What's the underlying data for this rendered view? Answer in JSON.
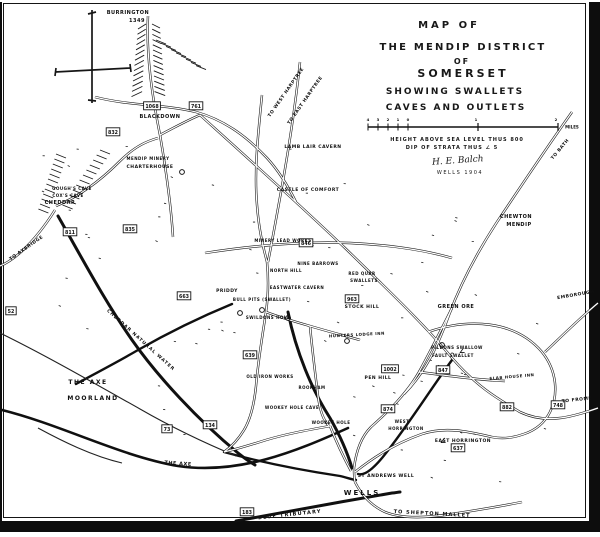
{
  "title": {
    "line1": "MAP OF",
    "line2": "THE MENDIP DISTRICT",
    "line3": "OF",
    "line4": "SOMERSET",
    "line5": "SHOWING SWALLETS",
    "line6": "CAVES AND OUTLETS"
  },
  "notes": {
    "height_note": "HEIGHT ABOVE SEA LEVEL THUS 800",
    "dip_note": "DIP OF STRATA THUS ∠ 5",
    "signature": "H. E. Balch",
    "place_date": "WELLS 1904"
  },
  "scale": {
    "furlong_labels": [
      "4",
      "3",
      "2",
      "1",
      "0"
    ],
    "mile_labels": [
      "1",
      "2"
    ],
    "unit": "MILES"
  },
  "colors": {
    "ink": "#161616",
    "paper": "#ffffff"
  },
  "compass": {
    "name": "north-cross"
  },
  "labels": [
    {
      "text": "BURRINGTON",
      "x": 128,
      "y": 14,
      "fs": 5
    },
    {
      "text": "1349",
      "x": 137,
      "y": 22,
      "fs": 5
    },
    {
      "text": "BLACKDOWN",
      "x": 160,
      "y": 118,
      "fs": 5
    },
    {
      "text": "MENDIP MINERY",
      "x": 148,
      "y": 160,
      "fs": 4
    },
    {
      "text": "CHARTERHOUSE",
      "x": 150,
      "y": 168,
      "fs": 4.5
    },
    {
      "text": "GOUGH'S CAVE",
      "x": 72,
      "y": 190,
      "fs": 4
    },
    {
      "text": "COX'S CAVE",
      "x": 68,
      "y": 197,
      "fs": 4
    },
    {
      "text": "CHEDDAR",
      "x": 60,
      "y": 204,
      "fs": 5
    },
    {
      "text": "TO AXBRIDGE",
      "x": 27,
      "y": 249,
      "fs": 4.5,
      "rot": -35
    },
    {
      "text": "LAMB LAIR CAVERN",
      "x": 313,
      "y": 148,
      "fs": 4.5
    },
    {
      "text": "CASTLE OF COMFORT",
      "x": 308,
      "y": 191,
      "fs": 4.5
    },
    {
      "text": "TO WEST HARPTREE",
      "x": 287,
      "y": 93,
      "fs": 4.5,
      "rot": -55
    },
    {
      "text": "TO EAST HARPTREE",
      "x": 306,
      "y": 101,
      "fs": 4.5,
      "rot": -55
    },
    {
      "text": "TO BATH",
      "x": 561,
      "y": 150,
      "fs": 4.5,
      "rot": -50
    },
    {
      "text": "CHEWTON",
      "x": 516,
      "y": 218,
      "fs": 5
    },
    {
      "text": "MENDIP",
      "x": 519,
      "y": 226,
      "fs": 5
    },
    {
      "text": "GREEN ORE",
      "x": 456,
      "y": 308,
      "fs": 5
    },
    {
      "text": "EMBOROUGH",
      "x": 576,
      "y": 296,
      "fs": 4.5,
      "rot": -10
    },
    {
      "text": "MINERY LEAD WORKS",
      "x": 283,
      "y": 242,
      "fs": 4
    },
    {
      "text": "NORTH HILL",
      "x": 286,
      "y": 272,
      "fs": 4
    },
    {
      "text": "PRIDDY",
      "x": 227,
      "y": 292,
      "fs": 4.5
    },
    {
      "text": "BULL PITS (SWALLET)",
      "x": 262,
      "y": 301,
      "fs": 4
    },
    {
      "text": "EASTWATER CAVERN",
      "x": 297,
      "y": 289,
      "fs": 4
    },
    {
      "text": "SWILDONS HOLE",
      "x": 268,
      "y": 319,
      "fs": 4
    },
    {
      "text": "NINE BARROWS",
      "x": 318,
      "y": 265,
      "fs": 4
    },
    {
      "text": "STOCK HILL",
      "x": 362,
      "y": 308,
      "fs": 4.5
    },
    {
      "text": "RED QUAR",
      "x": 362,
      "y": 275,
      "fs": 4
    },
    {
      "text": "SWALLETS",
      "x": 364,
      "y": 282,
      "fs": 4
    },
    {
      "text": "HUNTERS LODGE INN",
      "x": 357,
      "y": 336,
      "fs": 4,
      "rot": -3
    },
    {
      "text": "PEN HILL",
      "x": 378,
      "y": 379,
      "fs": 4.5
    },
    {
      "text": "OLD IRON WORKS",
      "x": 270,
      "y": 378,
      "fs": 4
    },
    {
      "text": "ROOKHAM",
      "x": 312,
      "y": 389,
      "fs": 4
    },
    {
      "text": "WOOKEY HOLE CAVE",
      "x": 292,
      "y": 409,
      "fs": 4
    },
    {
      "text": "WOOKEY HOLE",
      "x": 331,
      "y": 424,
      "fs": 4
    },
    {
      "text": "WEST",
      "x": 402,
      "y": 423,
      "fs": 4
    },
    {
      "text": "HORRINGTON",
      "x": 406,
      "y": 430,
      "fs": 4
    },
    {
      "text": "EAST HORRINGTON",
      "x": 463,
      "y": 442,
      "fs": 4.5
    },
    {
      "text": "SLAB HOUSE INN",
      "x": 512,
      "y": 378,
      "fs": 4,
      "rot": -5
    },
    {
      "text": "PILDONS SWALLOW",
      "x": 457,
      "y": 349,
      "fs": 4
    },
    {
      "text": "FAULT SWALLET",
      "x": 453,
      "y": 357,
      "fs": 4
    },
    {
      "text": "ST ANDREWS WELL",
      "x": 386,
      "y": 477,
      "fs": 4.5
    },
    {
      "text": "WELLS",
      "x": 362,
      "y": 495,
      "fs": 7,
      "ls": 2
    },
    {
      "text": "THE AXE",
      "x": 88,
      "y": 384,
      "fs": 6,
      "ls": 1.5
    },
    {
      "text": "MOORLAND",
      "x": 93,
      "y": 400,
      "fs": 6,
      "ls": 1.5
    },
    {
      "text": "THE AXE",
      "x": 178,
      "y": 465,
      "fs": 5,
      "rot": 4
    },
    {
      "text": "BLUE TRIBUTARY",
      "x": 290,
      "y": 516,
      "fs": 5,
      "rot": -6,
      "ls": 1.2
    },
    {
      "text": "TO SHEPTON MALLET",
      "x": 432,
      "y": 515,
      "fs": 5,
      "rot": 3,
      "ls": 1
    },
    {
      "text": "TO FROME",
      "x": 577,
      "y": 401,
      "fs": 4.5,
      "rot": -6
    },
    {
      "text": "CHEDDAR NATURAL WATER",
      "x": 140,
      "y": 341,
      "fs": 4.5,
      "rot": 42,
      "ls": 1
    }
  ],
  "elevation_boxes": [
    {
      "value": "1068",
      "x": 152,
      "y": 106
    },
    {
      "value": "832",
      "x": 113,
      "y": 132
    },
    {
      "value": "761",
      "x": 196,
      "y": 106
    },
    {
      "value": "811",
      "x": 70,
      "y": 232
    },
    {
      "value": "835",
      "x": 130,
      "y": 229
    },
    {
      "value": "663",
      "x": 184,
      "y": 296
    },
    {
      "value": "52",
      "x": 11,
      "y": 311
    },
    {
      "value": "639",
      "x": 250,
      "y": 355
    },
    {
      "value": "73",
      "x": 167,
      "y": 429
    },
    {
      "value": "134",
      "x": 210,
      "y": 425
    },
    {
      "value": "183",
      "x": 247,
      "y": 512
    },
    {
      "value": "846",
      "x": 306,
      "y": 243
    },
    {
      "value": "963",
      "x": 352,
      "y": 299
    },
    {
      "value": "1002",
      "x": 390,
      "y": 369
    },
    {
      "value": "874",
      "x": 388,
      "y": 409
    },
    {
      "value": "847",
      "x": 443,
      "y": 370
    },
    {
      "value": "882",
      "x": 507,
      "y": 407
    },
    {
      "value": "748",
      "x": 558,
      "y": 405
    },
    {
      "value": "637",
      "x": 458,
      "y": 448
    }
  ],
  "swallet_circles": [
    {
      "x": 182,
      "y": 172
    },
    {
      "x": 442,
      "y": 345
    },
    {
      "x": 240,
      "y": 313
    },
    {
      "x": 288,
      "y": 318
    },
    {
      "x": 262,
      "y": 310
    },
    {
      "x": 347,
      "y": 341
    }
  ],
  "dip_marks": [
    {
      "x": 443,
      "y": 443
    },
    {
      "x": 462,
      "y": 353
    }
  ]
}
